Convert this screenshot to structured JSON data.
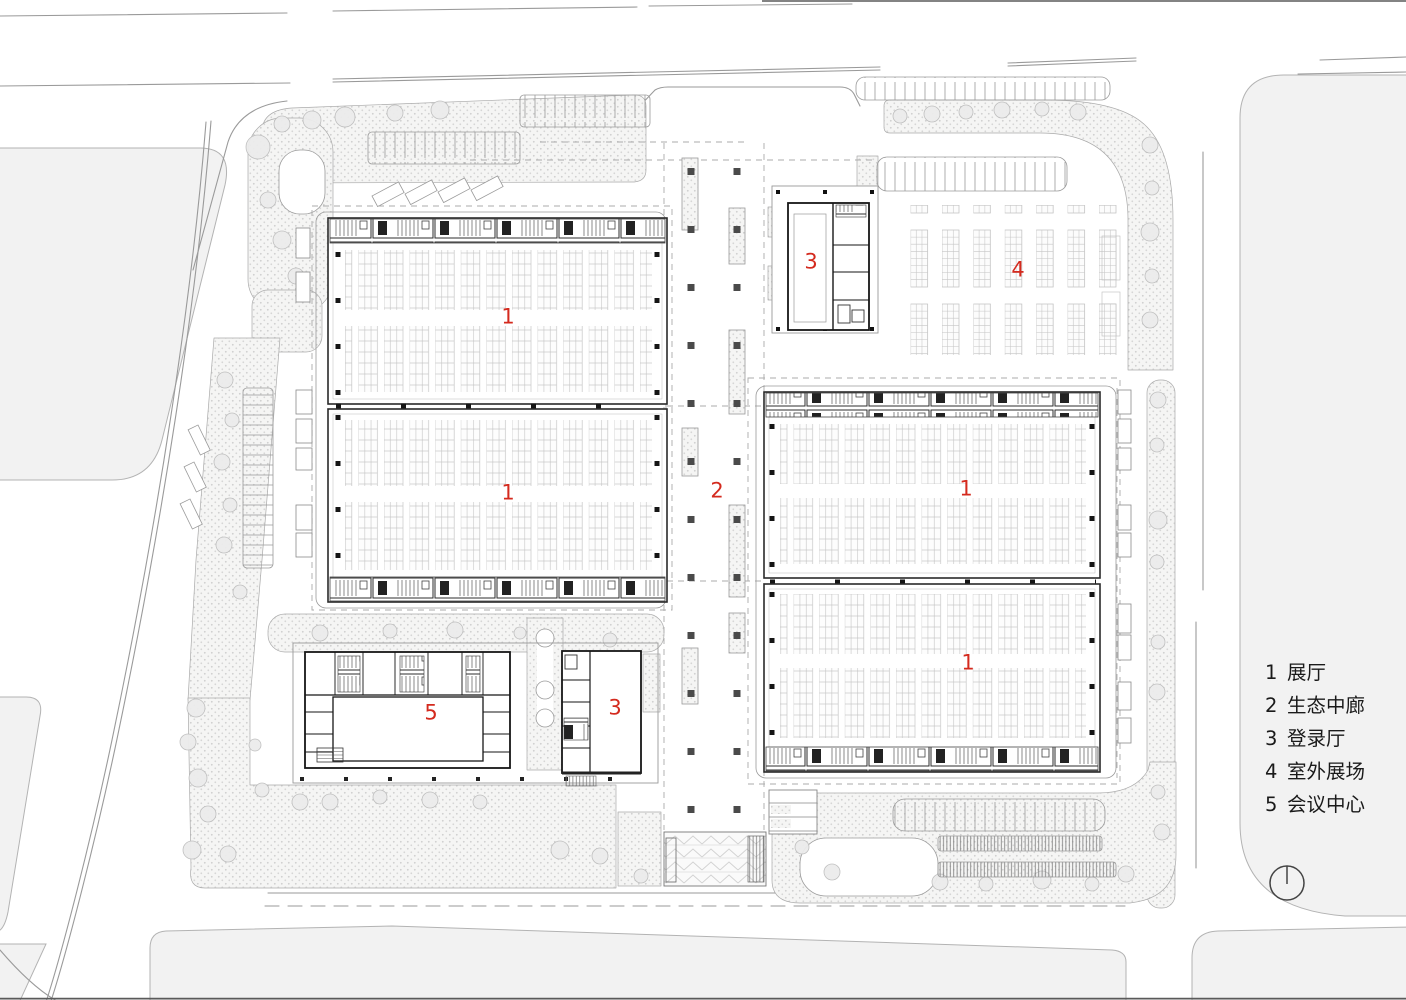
{
  "legend": {
    "items": [
      {
        "num": "1",
        "label": "展厅"
      },
      {
        "num": "2",
        "label": "生态中廊"
      },
      {
        "num": "3",
        "label": "登录厅"
      },
      {
        "num": "4",
        "label": "室外展场"
      },
      {
        "num": "5",
        "label": "会议中心"
      }
    ]
  },
  "plan_labels": [
    {
      "id": "hall-nw",
      "text": "1"
    },
    {
      "id": "hall-sw",
      "text": "1"
    },
    {
      "id": "corridor",
      "text": "2"
    },
    {
      "id": "registration-north",
      "text": "3"
    },
    {
      "id": "outdoor-exhibition",
      "text": "4"
    },
    {
      "id": "hall-ne",
      "text": "1"
    },
    {
      "id": "hall-se",
      "text": "1"
    },
    {
      "id": "conference-center",
      "text": "5"
    },
    {
      "id": "registration-south",
      "text": "3"
    }
  ],
  "north_indicator": {
    "symbol": "circle-with-line"
  },
  "colors": {
    "label_red": "#d42a1e",
    "drawing_line": "#9a9a9a",
    "building_line": "#1c1c1c",
    "city_block_fill": "#f2f2f2",
    "landscape_fill": "#f5f5f4"
  }
}
